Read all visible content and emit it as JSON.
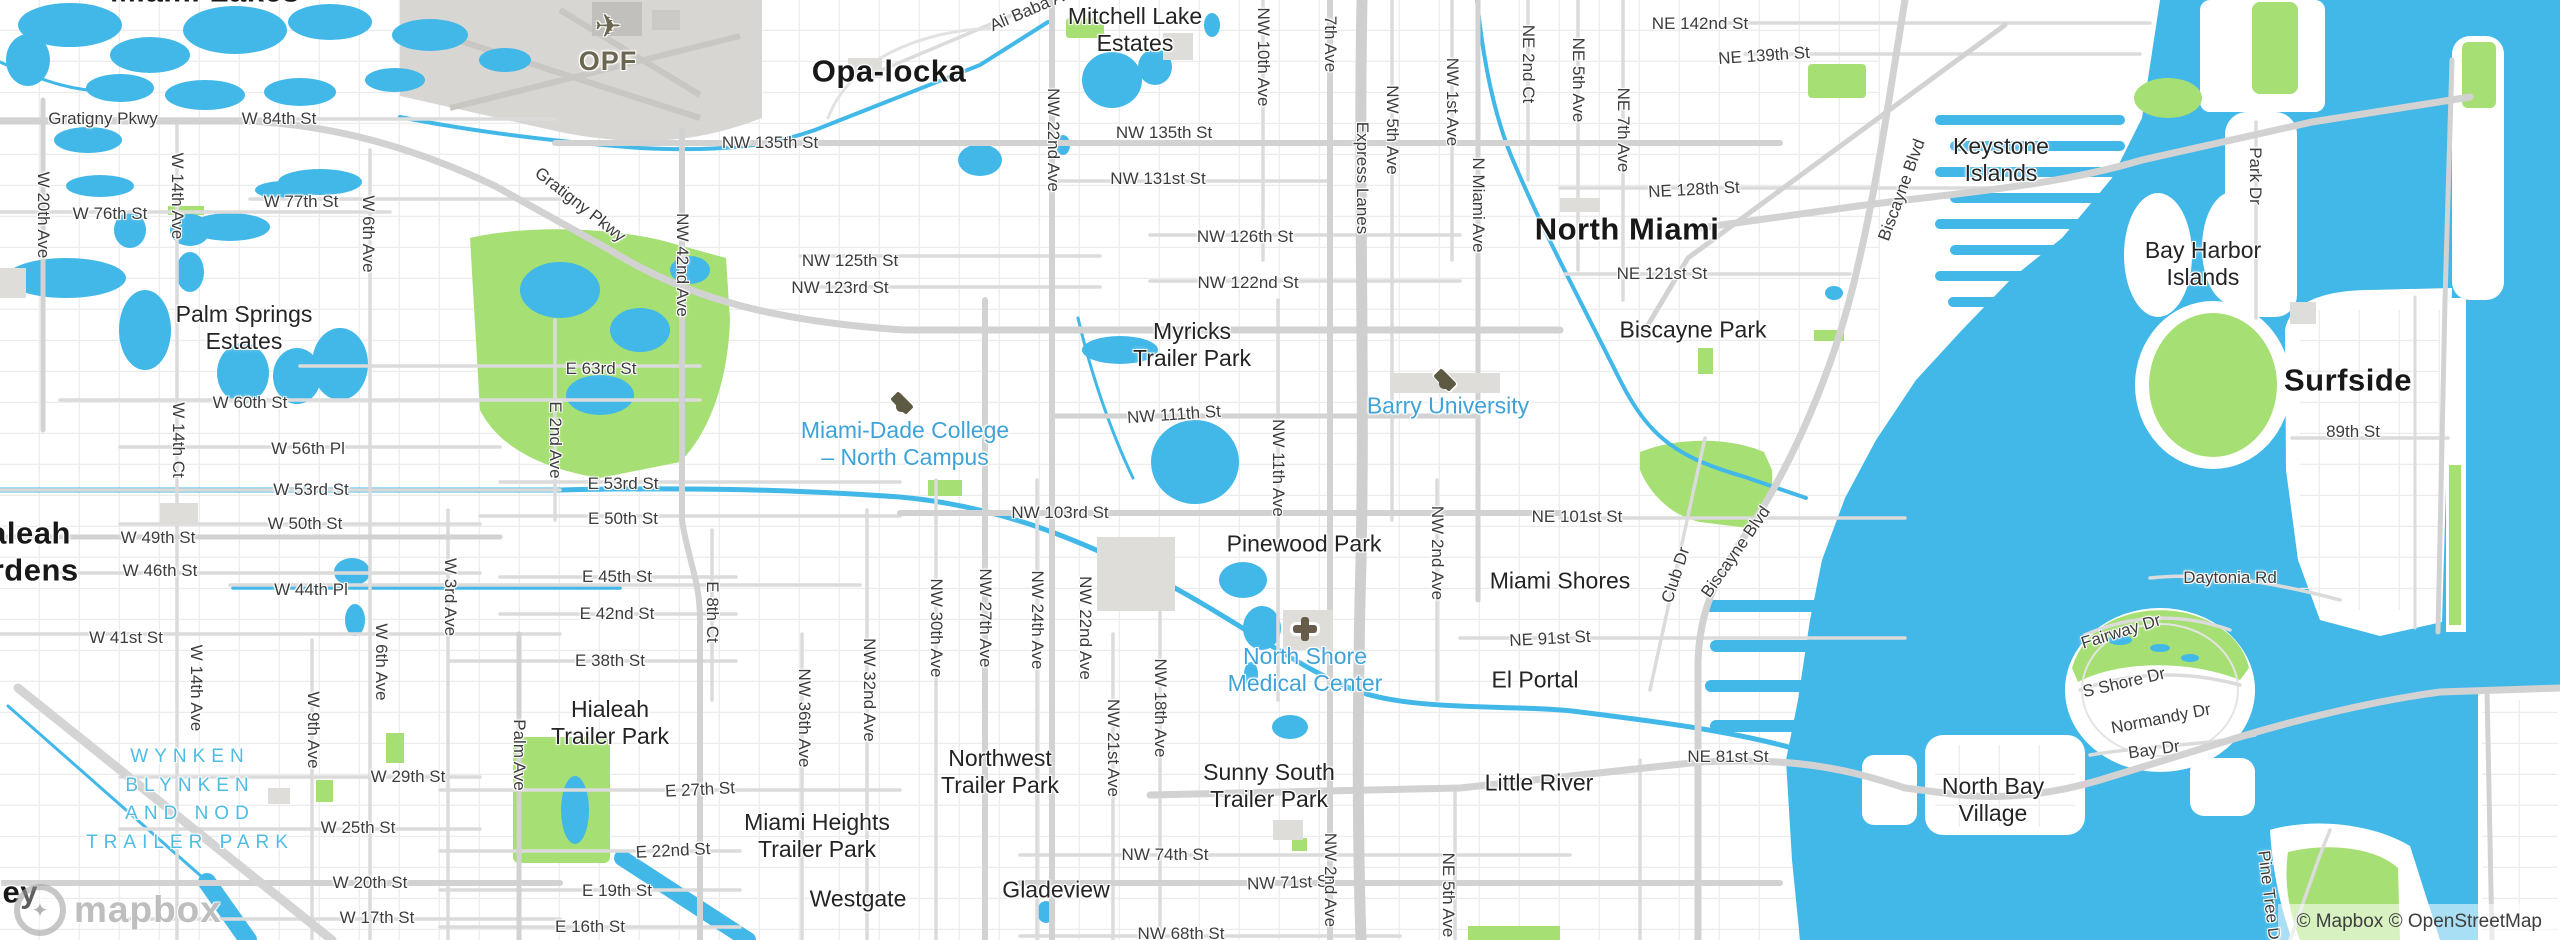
{
  "map": {
    "attribution": "© Mapbox © OpenStreetMap",
    "logo_text": "mapbox",
    "logo_glyph": "✦",
    "plane_glyph": "✈",
    "colors": {
      "water": "#42b8e8",
      "park": "#a6df73",
      "land": "#ffffff",
      "road_major": "#d2d2d2",
      "road_minor": "#e7e7e7",
      "poi_text": "#3fa3d8",
      "neighborhood_accent": "#4fbce4",
      "airport_fill": "#d8d6d3"
    },
    "icons": [
      {
        "k": "college",
        "x": 902,
        "y": 403
      },
      {
        "k": "college",
        "x": 1445,
        "y": 380
      },
      {
        "k": "hospital",
        "x": 1305,
        "y": 629
      },
      {
        "k": "plane",
        "x": 608,
        "y": 26
      }
    ],
    "labels": [
      {
        "t": "Miami Lakes",
        "x": 205,
        "y": -8,
        "c": "city"
      },
      {
        "t": "Opa-locka",
        "x": 889,
        "y": 72,
        "c": "city"
      },
      {
        "t": "North Miami",
        "x": 1627,
        "y": 230,
        "c": "city"
      },
      {
        "t": "Surfside",
        "x": 2348,
        "y": 381,
        "c": "city"
      },
      {
        "t": "Hialeah\nGardens",
        "x": 14,
        "y": 552,
        "c": "city"
      },
      {
        "t": "Medley",
        "x": -16,
        "y": 893,
        "c": "city"
      },
      {
        "t": "Mitchell Lake\nEstates",
        "x": 1135,
        "y": 30,
        "c": "hood"
      },
      {
        "t": "Keystone\nIslands",
        "x": 2001,
        "y": 160,
        "c": "hood"
      },
      {
        "t": "Bay Harbor\nIslands",
        "x": 2203,
        "y": 264,
        "c": "hood"
      },
      {
        "t": "Palm Springs\nEstates",
        "x": 244,
        "y": 328,
        "c": "hood"
      },
      {
        "t": "Myricks\nTrailer Park",
        "x": 1192,
        "y": 345,
        "c": "hood"
      },
      {
        "t": "Biscayne Park",
        "x": 1693,
        "y": 330,
        "c": "hood"
      },
      {
        "t": "Pinewood Park",
        "x": 1304,
        "y": 544,
        "c": "hood"
      },
      {
        "t": "Miami Shores",
        "x": 1560,
        "y": 581,
        "c": "hood"
      },
      {
        "t": "El Portal",
        "x": 1535,
        "y": 680,
        "c": "hood"
      },
      {
        "t": "Little River",
        "x": 1539,
        "y": 783,
        "c": "hood"
      },
      {
        "t": "North Bay\nVillage",
        "x": 1993,
        "y": 800,
        "c": "hood"
      },
      {
        "t": "Hialeah\nTrailer Park",
        "x": 610,
        "y": 723,
        "c": "hood"
      },
      {
        "t": "Northwest\nTrailer Park",
        "x": 1000,
        "y": 772,
        "c": "hood"
      },
      {
        "t": "Sunny South\nTrailer Park",
        "x": 1269,
        "y": 786,
        "c": "hood"
      },
      {
        "t": "Miami Heights\nTrailer Park",
        "x": 817,
        "y": 836,
        "c": "hood"
      },
      {
        "t": "Westgate",
        "x": 858,
        "y": 899,
        "c": "hood"
      },
      {
        "t": "Gladeview",
        "x": 1056,
        "y": 890,
        "c": "hood"
      },
      {
        "t": "WYNKEN\nBLYNKEN\nAND NOD\nTRAILER PARK",
        "x": 190,
        "y": 800,
        "c": "hoodcyan"
      },
      {
        "t": "Miami-Dade College\n– North Campus",
        "x": 905,
        "y": 444,
        "c": "poi"
      },
      {
        "t": "Barry University",
        "x": 1448,
        "y": 406,
        "c": "poi"
      },
      {
        "t": "North Shore\nMedical Center",
        "x": 1305,
        "y": 670,
        "c": "poi"
      },
      {
        "t": "OPF",
        "x": 608,
        "y": 62,
        "c": "airport"
      },
      {
        "t": "Gratigny Pkwy",
        "x": 103,
        "y": 119,
        "c": "street"
      },
      {
        "t": "Gratigny Pkwy",
        "x": 580,
        "y": 205,
        "c": "streetd",
        "r": 38
      },
      {
        "t": "W 84th St",
        "x": 279,
        "y": 119,
        "c": "street"
      },
      {
        "t": "W 76th St",
        "x": 110,
        "y": 214,
        "c": "street"
      },
      {
        "t": "W 77th St",
        "x": 301,
        "y": 202,
        "c": "street"
      },
      {
        "t": "W 60th St",
        "x": 250,
        "y": 403,
        "c": "street"
      },
      {
        "t": "W 56th Pl",
        "x": 308,
        "y": 449,
        "c": "street"
      },
      {
        "t": "W 53rd St",
        "x": 311,
        "y": 490,
        "c": "street"
      },
      {
        "t": "W 50th St",
        "x": 305,
        "y": 524,
        "c": "street"
      },
      {
        "t": "W 49th St",
        "x": 158,
        "y": 538,
        "c": "street"
      },
      {
        "t": "W 46th St",
        "x": 160,
        "y": 571,
        "c": "street"
      },
      {
        "t": "W 44th Pl",
        "x": 311,
        "y": 590,
        "c": "street"
      },
      {
        "t": "W 41st St",
        "x": 126,
        "y": 638,
        "c": "street"
      },
      {
        "t": "W 29th St",
        "x": 408,
        "y": 777,
        "c": "street"
      },
      {
        "t": "W 25th St",
        "x": 358,
        "y": 828,
        "c": "street"
      },
      {
        "t": "W 20th St",
        "x": 370,
        "y": 883,
        "c": "street"
      },
      {
        "t": "W 17th St",
        "x": 377,
        "y": 918,
        "c": "street"
      },
      {
        "t": "E 63rd St",
        "x": 601,
        "y": 369,
        "c": "street"
      },
      {
        "t": "E 53rd St",
        "x": 623,
        "y": 484,
        "c": "street"
      },
      {
        "t": "E 50th St",
        "x": 623,
        "y": 519,
        "c": "street"
      },
      {
        "t": "E 45th St",
        "x": 617,
        "y": 577,
        "c": "street"
      },
      {
        "t": "E 42nd St",
        "x": 617,
        "y": 614,
        "c": "street"
      },
      {
        "t": "E 38th St",
        "x": 610,
        "y": 661,
        "c": "street"
      },
      {
        "t": "E 27th St",
        "x": 700,
        "y": 790,
        "c": "streetd",
        "r": -3
      },
      {
        "t": "E 22nd St",
        "x": 673,
        "y": 851,
        "c": "streetd",
        "r": -3
      },
      {
        "t": "E 19th St",
        "x": 617,
        "y": 891,
        "c": "street"
      },
      {
        "t": "E 16th St",
        "x": 590,
        "y": 927,
        "c": "street"
      },
      {
        "t": "Ali Baba Ave",
        "x": 1035,
        "y": 8,
        "c": "streetd",
        "r": -23
      },
      {
        "t": "NW 135th St",
        "x": 770,
        "y": 143,
        "c": "street"
      },
      {
        "t": "NW 135th St",
        "x": 1164,
        "y": 133,
        "c": "street"
      },
      {
        "t": "NW 131st St",
        "x": 1158,
        "y": 179,
        "c": "street"
      },
      {
        "t": "NW 126th St",
        "x": 1245,
        "y": 237,
        "c": "street"
      },
      {
        "t": "NW 122nd St",
        "x": 1248,
        "y": 283,
        "c": "street"
      },
      {
        "t": "NW 125th St",
        "x": 850,
        "y": 261,
        "c": "street"
      },
      {
        "t": "NW 123rd St",
        "x": 840,
        "y": 288,
        "c": "street"
      },
      {
        "t": "NW 111th St",
        "x": 1174,
        "y": 415,
        "c": "streetd",
        "r": -4
      },
      {
        "t": "NW 103rd St",
        "x": 1060,
        "y": 513,
        "c": "street"
      },
      {
        "t": "NE 142nd St",
        "x": 1700,
        "y": 24,
        "c": "street"
      },
      {
        "t": "NE 139th St",
        "x": 1764,
        "y": 56,
        "c": "streetd",
        "r": -4
      },
      {
        "t": "NE 128th St",
        "x": 1694,
        "y": 190,
        "c": "streetd",
        "r": -3
      },
      {
        "t": "NE 121st St",
        "x": 1662,
        "y": 274,
        "c": "street"
      },
      {
        "t": "NE 101st St",
        "x": 1577,
        "y": 517,
        "c": "street"
      },
      {
        "t": "NE 91st St",
        "x": 1550,
        "y": 639,
        "c": "streetd",
        "r": -3
      },
      {
        "t": "NE 81st St",
        "x": 1728,
        "y": 757,
        "c": "street"
      },
      {
        "t": "NW 74th St",
        "x": 1165,
        "y": 855,
        "c": "street"
      },
      {
        "t": "NW 71st St",
        "x": 1290,
        "y": 883,
        "c": "streetd",
        "r": -2
      },
      {
        "t": "NW 68th St",
        "x": 1181,
        "y": 934,
        "c": "street"
      },
      {
        "t": "89th St",
        "x": 2353,
        "y": 432,
        "c": "street"
      },
      {
        "t": "Daytonia Rd",
        "x": 2230,
        "y": 578,
        "c": "street"
      },
      {
        "t": "Fairway Dr",
        "x": 2121,
        "y": 632,
        "c": "streetd",
        "r": -17
      },
      {
        "t": "S Shore Dr",
        "x": 2124,
        "y": 683,
        "c": "streetd",
        "r": -13
      },
      {
        "t": "Normandy Dr",
        "x": 2161,
        "y": 719,
        "c": "streetd",
        "r": -11
      },
      {
        "t": "Bay Dr",
        "x": 2154,
        "y": 750,
        "c": "streetd",
        "r": -8
      },
      {
        "t": "Biscayne Blvd",
        "x": 1902,
        "y": 190,
        "c": "streetd",
        "r": -70
      },
      {
        "t": "Biscayne Blvd",
        "x": 1736,
        "y": 552,
        "c": "streetd",
        "r": -55
      },
      {
        "t": "Club Dr",
        "x": 1676,
        "y": 575,
        "c": "streetd",
        "r": -72
      },
      {
        "t": "Park Dr",
        "x": 2255,
        "y": 176,
        "c": "streetv"
      },
      {
        "t": "Pine Tree Dr",
        "x": 2269,
        "y": 898,
        "c": "streetd",
        "r": 83
      },
      {
        "t": "W 20th Ave",
        "x": 43,
        "y": 215,
        "c": "streetv"
      },
      {
        "t": "W 14th Ave",
        "x": 177,
        "y": 196,
        "c": "streetv"
      },
      {
        "t": "W 14th Ct",
        "x": 178,
        "y": 440,
        "c": "streetv"
      },
      {
        "t": "W 14th Ave",
        "x": 196,
        "y": 688,
        "c": "streetv"
      },
      {
        "t": "W 6th Ave",
        "x": 368,
        "y": 234,
        "c": "streetv"
      },
      {
        "t": "W 6th Ave",
        "x": 381,
        "y": 662,
        "c": "streetv"
      },
      {
        "t": "W 9th Ave",
        "x": 313,
        "y": 730,
        "c": "streetv"
      },
      {
        "t": "W 3rd Ave",
        "x": 450,
        "y": 597,
        "c": "streetv"
      },
      {
        "t": "Palm Ave",
        "x": 519,
        "y": 755,
        "c": "streetv"
      },
      {
        "t": "E 2nd Ave",
        "x": 555,
        "y": 440,
        "c": "streetv"
      },
      {
        "t": "E 8th Ct",
        "x": 712,
        "y": 612,
        "c": "streetv"
      },
      {
        "t": "NW 42nd Ave",
        "x": 682,
        "y": 265,
        "c": "streetv"
      },
      {
        "t": "NW 36th Ave",
        "x": 804,
        "y": 718,
        "c": "streetv"
      },
      {
        "t": "NW 32nd Ave",
        "x": 869,
        "y": 690,
        "c": "streetv"
      },
      {
        "t": "NW 30th Ave",
        "x": 936,
        "y": 628,
        "c": "streetv"
      },
      {
        "t": "NW 27th Ave",
        "x": 985,
        "y": 618,
        "c": "streetv"
      },
      {
        "t": "NW 24th Ave",
        "x": 1037,
        "y": 620,
        "c": "streetv"
      },
      {
        "t": "NW 22nd Ave",
        "x": 1053,
        "y": 140,
        "c": "streetv"
      },
      {
        "t": "NW 22nd Ave",
        "x": 1085,
        "y": 628,
        "c": "streetv"
      },
      {
        "t": "NW 21st Ave",
        "x": 1113,
        "y": 748,
        "c": "streetv"
      },
      {
        "t": "NW 18th Ave",
        "x": 1160,
        "y": 708,
        "c": "streetv"
      },
      {
        "t": "NW 11th Ave",
        "x": 1278,
        "y": 468,
        "c": "streetv"
      },
      {
        "t": "NW 10th Ave",
        "x": 1263,
        "y": 57,
        "c": "streetv"
      },
      {
        "t": "7th Ave",
        "x": 1330,
        "y": 44,
        "c": "streetv"
      },
      {
        "t": "Express Lanes",
        "x": 1362,
        "y": 178,
        "c": "streetv"
      },
      {
        "t": "NW 5th Ave",
        "x": 1392,
        "y": 130,
        "c": "streetv"
      },
      {
        "t": "NW 1st Ave",
        "x": 1452,
        "y": 102,
        "c": "streetv"
      },
      {
        "t": "N Miami Ave",
        "x": 1478,
        "y": 205,
        "c": "streetv"
      },
      {
        "t": "NE 2nd Ct",
        "x": 1528,
        "y": 64,
        "c": "streetv"
      },
      {
        "t": "NE 5th Ave",
        "x": 1578,
        "y": 80,
        "c": "streetv"
      },
      {
        "t": "NE 7th Ave",
        "x": 1623,
        "y": 130,
        "c": "streetv"
      },
      {
        "t": "NW 2nd Ave",
        "x": 1437,
        "y": 553,
        "c": "streetv"
      },
      {
        "t": "NW 2nd Ave",
        "x": 1330,
        "y": 880,
        "c": "streetv"
      },
      {
        "t": "NE 5th Ave",
        "x": 1448,
        "y": 895,
        "c": "streetv"
      }
    ]
  }
}
